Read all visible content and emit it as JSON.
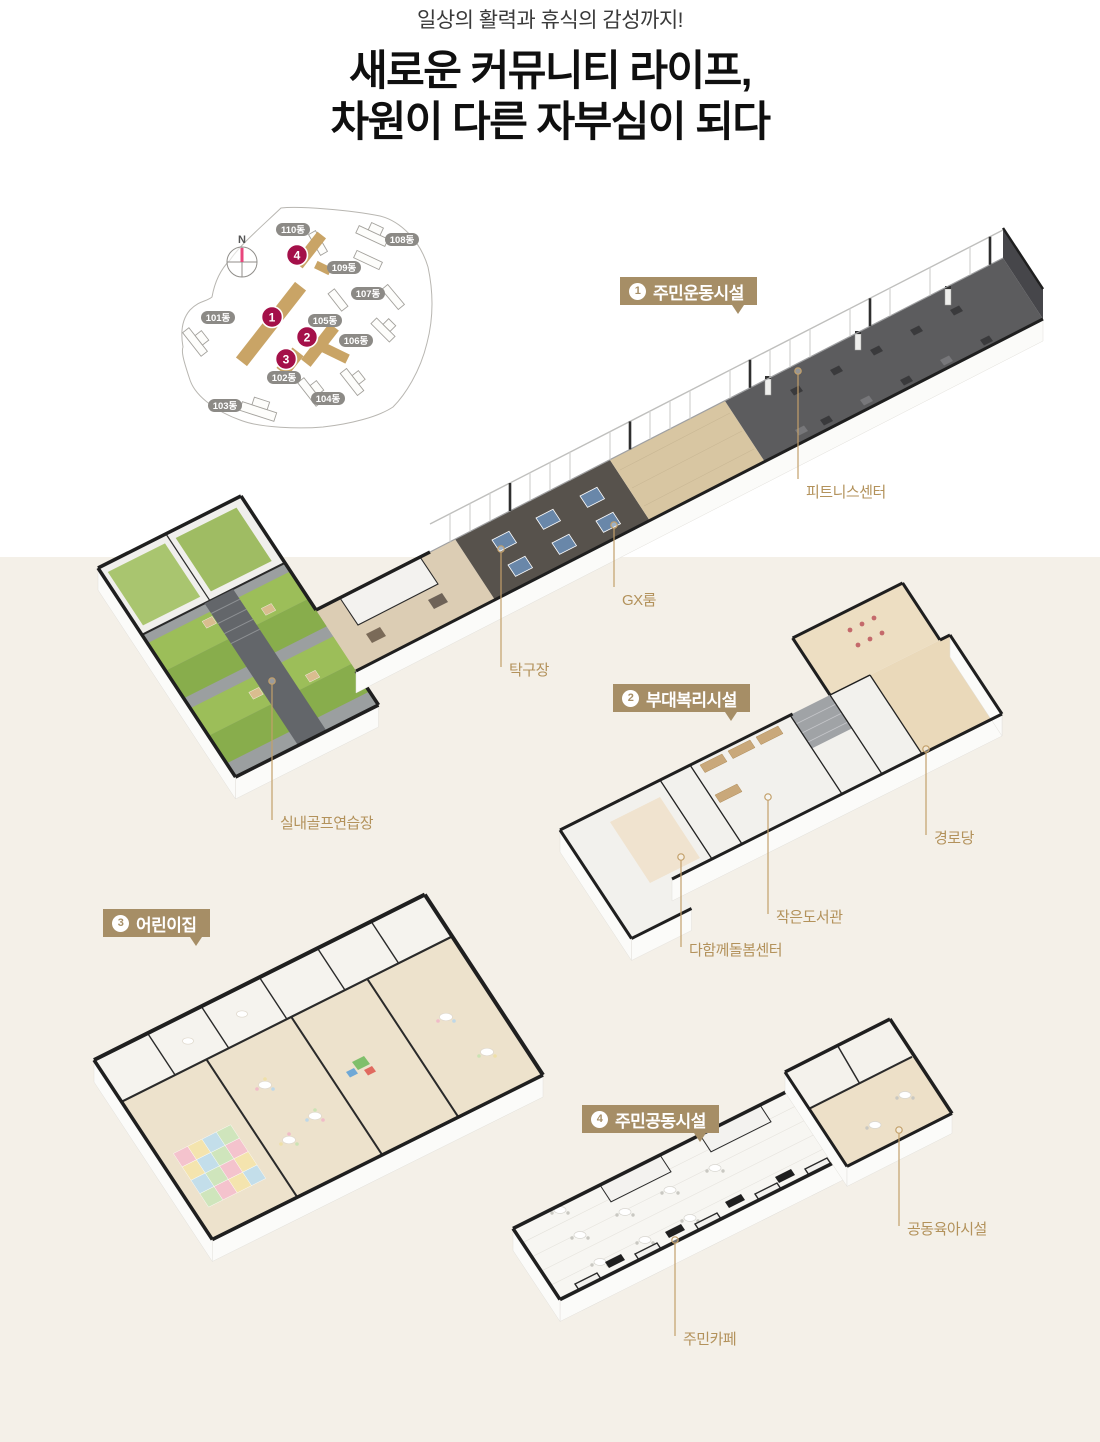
{
  "header": {
    "subtitle": "일상의 활력과 휴식의 감성까지!",
    "title_line1": "새로운 커뮤니티 라이프,",
    "title_line2": "차원이 다른 자부심이 되다"
  },
  "site_map": {
    "compass_label": "N",
    "buildings": [
      {
        "name": "101동"
      },
      {
        "name": "102동"
      },
      {
        "name": "103동"
      },
      {
        "name": "104동"
      },
      {
        "name": "105동"
      },
      {
        "name": "106동"
      },
      {
        "name": "107동"
      },
      {
        "name": "108동"
      },
      {
        "name": "109동"
      },
      {
        "name": "110동"
      }
    ],
    "markers": [
      {
        "number": "1"
      },
      {
        "number": "2"
      },
      {
        "number": "3"
      },
      {
        "number": "4"
      }
    ]
  },
  "facilities": [
    {
      "badge_number": "1",
      "name": "주민운동시설",
      "labels": [
        "피트니스센터",
        "GX룸",
        "탁구장",
        "실내골프연습장"
      ]
    },
    {
      "badge_number": "2",
      "name": "부대복리시설",
      "labels": [
        "경로당",
        "작은도서관",
        "다함께돌봄센터"
      ]
    },
    {
      "badge_number": "3",
      "name": "어린이집",
      "labels": []
    },
    {
      "badge_number": "4",
      "name": "주민공동시설",
      "labels": [
        "공동육아시설",
        "주민카페"
      ]
    }
  ],
  "colors": {
    "accent_gold": "#B3925B",
    "badge_background": "#A68E66",
    "marker_crimson": "#A41049",
    "section_background": "#F4F0E8",
    "turf_green": "#9CBE59",
    "table_tennis_blue": "#6987A9"
  }
}
